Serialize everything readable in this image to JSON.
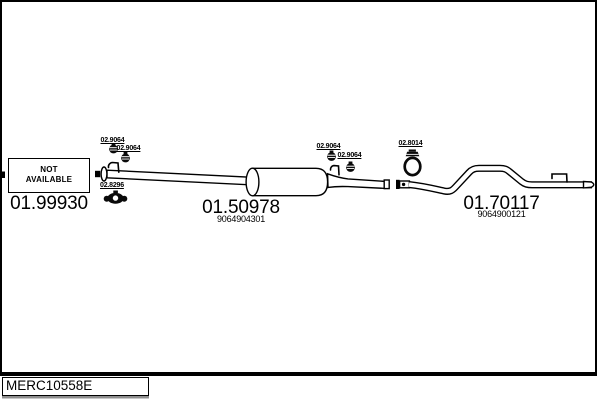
{
  "front": {
    "na_line1": "NOT",
    "na_line2": "AVAILABLE",
    "part_number": "01.99930"
  },
  "middle": {
    "part_number": "01.50978",
    "oe_reference": "9064904301"
  },
  "rear": {
    "part_number": "01.70117",
    "oe_reference": "9064900121"
  },
  "labels": {
    "left_clamp_top": "02.9064",
    "left_clamp_bottom": "02.9064",
    "left_mount": "02.8296",
    "mid_clamp_top": "02.9064",
    "mid_clamp_bottom": "02.9064",
    "rear_hanger": "02.8014"
  },
  "icons": {
    "clamp_icon": "worm-drive-pipe-clamp",
    "mount_icon": "rubber-mounting-bracket",
    "hanger_icon": "rubber-ring-hanger"
  },
  "footer": {
    "drawing_code": "MERC10558E"
  },
  "colors": {
    "ink": "#000000",
    "paper": "#ffffff",
    "shadow": "#8f8f8f"
  }
}
